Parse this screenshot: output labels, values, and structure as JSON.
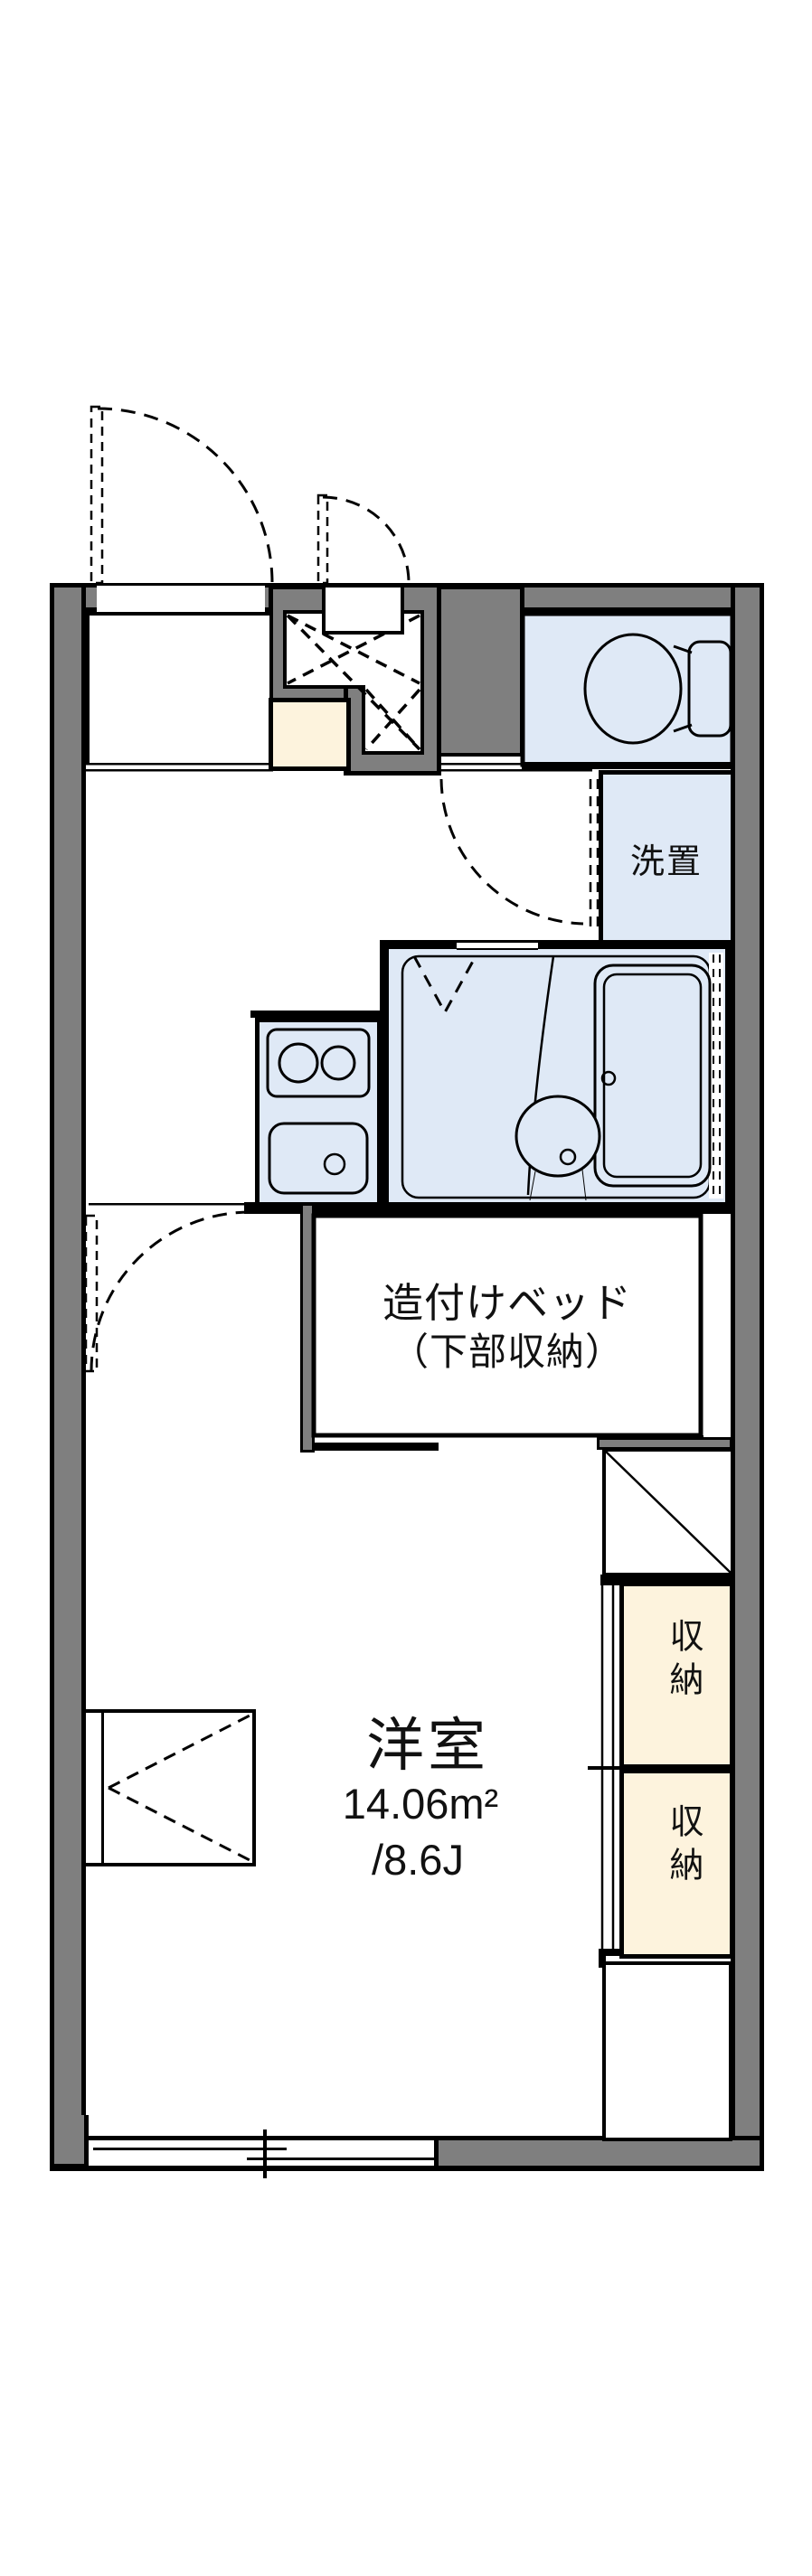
{
  "floorplan": {
    "labels": {
      "washer_space": "洗置",
      "bed_line1": "造付けベッド",
      "bed_line2": "（下部収納）",
      "room_name": "洋室",
      "room_area_sqm": "14.06m²",
      "room_area_jo": "/8.6J",
      "closet_upper": "収納",
      "closet_lower": "収納"
    },
    "colors": {
      "wall_gray": "#7f7f7f",
      "wet_area_blue": "#dfe9f6",
      "storage_cream": "#fdf3dd",
      "line_black": "#000000",
      "background": "#ffffff"
    }
  }
}
